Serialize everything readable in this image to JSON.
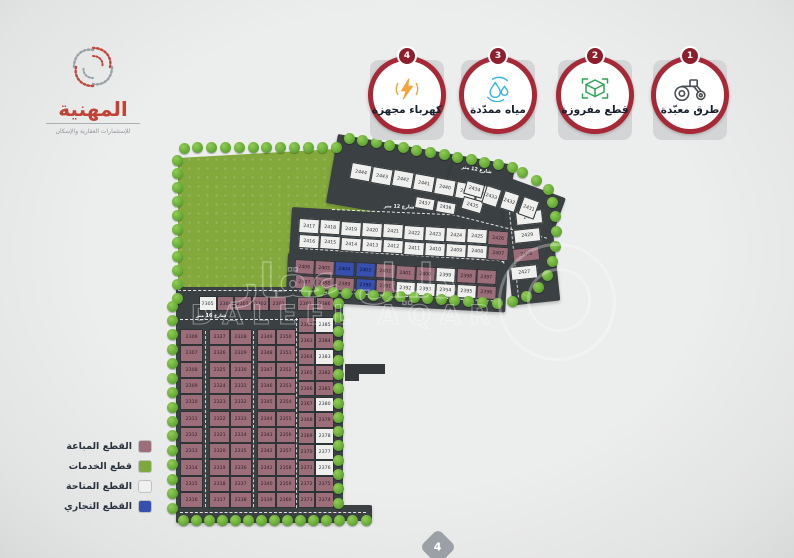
{
  "logo": {
    "title": "المهنية",
    "subtitle": "للإستثمارات العقارية والإسكان"
  },
  "badges": [
    {
      "num": "1",
      "label": "طرق معبّدة",
      "icon": "road-roller-icon"
    },
    {
      "num": "2",
      "label": "قطع مفروزة",
      "icon": "surveyed-plots-icon"
    },
    {
      "num": "3",
      "label": "مياه ممدّدة",
      "icon": "water-drops-icon"
    },
    {
      "num": "4",
      "label": "كهرباء مجهزة",
      "icon": "electricity-bolt-icon"
    }
  ],
  "legend": {
    "items": [
      {
        "key": "sold",
        "label": "القطع المباعة",
        "color": "#9b6e7a"
      },
      {
        "key": "service",
        "label": "قطع الخدمات",
        "color": "#7ca83d"
      },
      {
        "key": "available",
        "label": "القطع المتاحة",
        "color": "#f0f0ee"
      },
      {
        "key": "commercial",
        "label": "القطع التجاري",
        "color": "#3750b0"
      }
    ]
  },
  "streets": {
    "s12": "شارع 12 متر",
    "s16": "شارع 16 متر"
  },
  "watermark": {
    "ar": "دليل عقار",
    "en": "DALEEL AQAR"
  },
  "page_number": "4",
  "map": {
    "colors": {
      "sold": "#9b6e7a",
      "service": "#7ca83d",
      "available": "#efefed",
      "commercial": "#3750b0",
      "road": "#3b4043"
    },
    "plots": {
      "top_row": [
        {
          "n": "2444",
          "s": "A"
        },
        {
          "n": "2443",
          "s": "A"
        },
        {
          "n": "2442",
          "s": "A"
        },
        {
          "n": "2441",
          "s": "A"
        },
        {
          "n": "2440",
          "s": "A"
        },
        {
          "n": "2439",
          "s": "A"
        },
        {
          "n": "2438",
          "s": "A"
        }
      ],
      "top_sub": [
        {
          "n": "2437",
          "s": "A"
        },
        {
          "n": "2436",
          "s": "A"
        }
      ],
      "fan": [
        {
          "n": "2434",
          "s": "A"
        },
        {
          "n": "2435",
          "s": "A"
        },
        {
          "n": "2433",
          "s": "A"
        },
        {
          "n": "2432",
          "s": "A"
        },
        {
          "n": "2431",
          "s": "A"
        }
      ],
      "strip2_top": [
        {
          "n": "2417",
          "s": "A"
        },
        {
          "n": "2418",
          "s": "A"
        },
        {
          "n": "2419",
          "s": "A"
        },
        {
          "n": "2420",
          "s": "A"
        },
        {
          "n": "2421",
          "s": "A"
        },
        {
          "n": "2422",
          "s": "A"
        },
        {
          "n": "2423",
          "s": "A"
        },
        {
          "n": "2424",
          "s": "A"
        },
        {
          "n": "2425",
          "s": "A"
        },
        {
          "n": "2426",
          "s": "S"
        }
      ],
      "strip2_bottom": [
        {
          "n": "2416",
          "s": "A"
        },
        {
          "n": "2415",
          "s": "A"
        },
        {
          "n": "2414",
          "s": "A"
        },
        {
          "n": "2413",
          "s": "A"
        },
        {
          "n": "2412",
          "s": "A"
        },
        {
          "n": "2411",
          "s": "A"
        },
        {
          "n": "2410",
          "s": "A"
        },
        {
          "n": "2409",
          "s": "A"
        },
        {
          "n": "2408",
          "s": "A"
        },
        {
          "n": "2407",
          "s": "S"
        }
      ],
      "right_col": [
        {
          "n": "2430",
          "s": "A"
        },
        {
          "n": "2429",
          "s": "A"
        },
        {
          "n": "2428",
          "s": "S"
        },
        {
          "n": "2427",
          "s": "A"
        }
      ],
      "strip3_top": [
        {
          "n": "2406",
          "s": "S"
        },
        {
          "n": "2405",
          "s": "S"
        },
        {
          "n": "2404",
          "s": "C"
        },
        {
          "n": "2403",
          "s": "C"
        },
        {
          "n": "2402",
          "s": "S"
        },
        {
          "n": "2401",
          "s": "S"
        },
        {
          "n": "2400",
          "s": "S"
        },
        {
          "n": "2399",
          "s": "A"
        },
        {
          "n": "2398",
          "s": "S"
        },
        {
          "n": "2397",
          "s": "S"
        }
      ],
      "strip3_bottom": [
        {
          "n": "2387",
          "s": "S"
        },
        {
          "n": "2388",
          "s": "S"
        },
        {
          "n": "2389",
          "s": "S"
        },
        {
          "n": "2390",
          "s": "C"
        },
        {
          "n": "2391",
          "s": "S"
        },
        {
          "n": "2392",
          "s": "A"
        },
        {
          "n": "2393",
          "s": "A"
        },
        {
          "n": "2394",
          "s": "A"
        },
        {
          "n": "2395",
          "s": "A"
        },
        {
          "n": "2396",
          "s": "S"
        }
      ],
      "block_top_row": [
        {
          "n": "2305",
          "s": "A"
        },
        {
          "n": "2304",
          "s": "S"
        },
        {
          "n": "2303",
          "s": "S"
        },
        {
          "n": "2302",
          "s": "S"
        },
        {
          "n": "2301",
          "s": "S"
        }
      ],
      "block_pair_top": [
        {
          "n": "2361",
          "s": "S"
        },
        {
          "n": "2386",
          "s": "S"
        }
      ],
      "col1": [
        {
          "n": "2306",
          "s": "S"
        },
        {
          "n": "2307",
          "s": "S"
        },
        {
          "n": "2308",
          "s": "S"
        },
        {
          "n": "2309",
          "s": "S"
        },
        {
          "n": "2310",
          "s": "S"
        },
        {
          "n": "2311",
          "s": "S"
        },
        {
          "n": "2312",
          "s": "S"
        },
        {
          "n": "2313",
          "s": "S"
        },
        {
          "n": "2314",
          "s": "S"
        },
        {
          "n": "2315",
          "s": "S"
        },
        {
          "n": "2316",
          "s": "S"
        }
      ],
      "col2": [
        {
          "n": "2327",
          "s": "S"
        },
        {
          "n": "2326",
          "s": "S"
        },
        {
          "n": "2325",
          "s": "S"
        },
        {
          "n": "2324",
          "s": "S"
        },
        {
          "n": "2323",
          "s": "S"
        },
        {
          "n": "2322",
          "s": "S"
        },
        {
          "n": "2321",
          "s": "S"
        },
        {
          "n": "2320",
          "s": "S"
        },
        {
          "n": "2319",
          "s": "S"
        },
        {
          "n": "2318",
          "s": "S"
        },
        {
          "n": "2317",
          "s": "S"
        }
      ],
      "col3": [
        {
          "n": "2328",
          "s": "S"
        },
        {
          "n": "2329",
          "s": "S"
        },
        {
          "n": "2330",
          "s": "S"
        },
        {
          "n": "2331",
          "s": "S"
        },
        {
          "n": "2332",
          "s": "S"
        },
        {
          "n": "2333",
          "s": "S"
        },
        {
          "n": "2334",
          "s": "S"
        },
        {
          "n": "2335",
          "s": "S"
        },
        {
          "n": "2336",
          "s": "S"
        },
        {
          "n": "2337",
          "s": "S"
        },
        {
          "n": "2338",
          "s": "S"
        }
      ],
      "col4": [
        {
          "n": "2349",
          "s": "S"
        },
        {
          "n": "2348",
          "s": "S"
        },
        {
          "n": "2347",
          "s": "S"
        },
        {
          "n": "2346",
          "s": "S"
        },
        {
          "n": "2345",
          "s": "S"
        },
        {
          "n": "2344",
          "s": "S"
        },
        {
          "n": "2343",
          "s": "S"
        },
        {
          "n": "2342",
          "s": "S"
        },
        {
          "n": "2341",
          "s": "S"
        },
        {
          "n": "2340",
          "s": "S"
        },
        {
          "n": "2339",
          "s": "S"
        }
      ],
      "col5": [
        {
          "n": "2350",
          "s": "S"
        },
        {
          "n": "2351",
          "s": "S"
        },
        {
          "n": "2352",
          "s": "S"
        },
        {
          "n": "2353",
          "s": "S"
        },
        {
          "n": "2354",
          "s": "S"
        },
        {
          "n": "2355",
          "s": "S"
        },
        {
          "n": "2356",
          "s": "S"
        },
        {
          "n": "2357",
          "s": "S"
        },
        {
          "n": "2358",
          "s": "S"
        },
        {
          "n": "2359",
          "s": "S"
        },
        {
          "n": "2360",
          "s": "S"
        }
      ],
      "col6": [
        {
          "n": "2362",
          "s": "S"
        },
        {
          "n": "2363",
          "s": "S"
        },
        {
          "n": "2364",
          "s": "S"
        },
        {
          "n": "2365",
          "s": "S"
        },
        {
          "n": "2366",
          "s": "S"
        },
        {
          "n": "2367",
          "s": "S"
        },
        {
          "n": "2368",
          "s": "S"
        },
        {
          "n": "2369",
          "s": "S"
        },
        {
          "n": "2370",
          "s": "S"
        },
        {
          "n": "2371",
          "s": "S"
        },
        {
          "n": "2372",
          "s": "S"
        },
        {
          "n": "2373",
          "s": "S"
        }
      ],
      "col7": [
        {
          "n": "2385",
          "s": "A"
        },
        {
          "n": "2384",
          "s": "S"
        },
        {
          "n": "2383",
          "s": "A"
        },
        {
          "n": "2382",
          "s": "S"
        },
        {
          "n": "2381",
          "s": "S"
        },
        {
          "n": "2380",
          "s": "A"
        },
        {
          "n": "2379",
          "s": "S"
        },
        {
          "n": "2378",
          "s": "A"
        },
        {
          "n": "2377",
          "s": "A"
        },
        {
          "n": "2376",
          "s": "A"
        },
        {
          "n": "2375",
          "s": "S"
        },
        {
          "n": "2374",
          "s": "S"
        }
      ]
    }
  }
}
